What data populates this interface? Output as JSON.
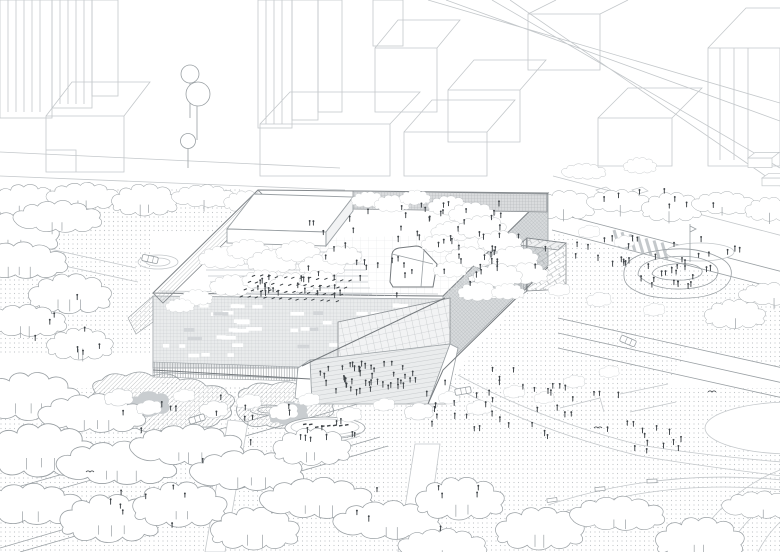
{
  "meta": {
    "title": "Axonometric architectural site drawing",
    "description": "Black-and-white axonometric line drawing of a large rectangular cultural building with a rooftop terrace full of trees and people, surrounded by plazas, parks with cloud-shaped trees, roads with cars, a playground spiral, a stage and crowds of tiny figures"
  },
  "palette": {
    "ink_light": "#c4c8cb",
    "ink_mid": "#9aa0a4",
    "ink_dark": "#757a7e",
    "figure": "#3e4347",
    "dot": "#c2c6c9",
    "facade_sw_fill": "#e9ebec",
    "facade_sw_tex": "#c3c7ca",
    "facade_se_fill": "#d7dadc",
    "facade_se_tex": "#aeb3b6",
    "pergola_fill": "#dadcde",
    "island_fill": "#e0e3e5",
    "island_dark": "#c9cdd0",
    "glass_fill": "#f2f3f4",
    "steps_fill": "#eaeced",
    "window_dark": "#d2d5d8",
    "roof_grid": "#e4e6e8"
  },
  "crowds": [
    {
      "name": "roof-event-audience",
      "cx": 305,
      "cy": 290,
      "rx": 55,
      "ry": 14,
      "n": 22,
      "seed": 11
    },
    {
      "name": "roof-scatter",
      "cx": 400,
      "cy": 250,
      "rx": 120,
      "ry": 48,
      "n": 40,
      "seed": 12
    },
    {
      "name": "roof-back-walk",
      "cx": 450,
      "cy": 212,
      "rx": 88,
      "ry": 10,
      "n": 14,
      "seed": 13
    },
    {
      "name": "roof-right-garden",
      "cx": 495,
      "cy": 255,
      "rx": 55,
      "ry": 40,
      "n": 16,
      "seed": 14
    },
    {
      "name": "entrance-steps-crowd",
      "cx": 368,
      "cy": 380,
      "rx": 50,
      "ry": 18,
      "n": 46,
      "seed": 15
    },
    {
      "name": "main-plaza-crowd",
      "cx": 520,
      "cy": 405,
      "rx": 120,
      "ry": 35,
      "n": 40,
      "seed": 16
    },
    {
      "name": "promenade-walkers",
      "cx": 660,
      "cy": 440,
      "rx": 90,
      "ry": 18,
      "n": 14,
      "seed": 17
    },
    {
      "name": "north-east-plaza",
      "cx": 610,
      "cy": 250,
      "rx": 55,
      "ry": 18,
      "n": 12,
      "seed": 18
    },
    {
      "name": "sidewalk-top",
      "cx": 660,
      "cy": 205,
      "rx": 100,
      "ry": 12,
      "n": 8,
      "seed": 19
    },
    {
      "name": "park-left",
      "cx": 140,
      "cy": 470,
      "rx": 130,
      "ry": 60,
      "n": 12,
      "seed": 20
    },
    {
      "name": "park-bottom",
      "cx": 430,
      "cy": 505,
      "rx": 120,
      "ry": 35,
      "n": 8,
      "seed": 21
    },
    {
      "name": "west-walk",
      "cx": 70,
      "cy": 330,
      "rx": 45,
      "ry": 38,
      "n": 8,
      "seed": 22
    },
    {
      "name": "garden-islands",
      "cx": 230,
      "cy": 408,
      "rx": 70,
      "ry": 14,
      "n": 10,
      "seed": 23
    },
    {
      "name": "stage-crowd",
      "cx": 330,
      "cy": 433,
      "rx": 40,
      "ry": 10,
      "n": 10,
      "seed": 24
    },
    {
      "name": "playground-kids",
      "cx": 678,
      "cy": 277,
      "rx": 40,
      "ry": 16,
      "n": 20,
      "seed": 25
    },
    {
      "name": "street-b-walkers",
      "cx": 640,
      "cy": 252,
      "rx": 110,
      "ry": 14,
      "n": 12,
      "seed": 26
    }
  ],
  "event_rows": {
    "x0": 252,
    "y0": 276,
    "cols": 13,
    "rows": 4,
    "dx": 8,
    "dy": 0.4,
    "row_dx": -4,
    "row_dy": 7,
    "seed": 31
  },
  "windows": {
    "x0": 158,
    "x1": 434,
    "rows": [
      304,
      312,
      320,
      328,
      336,
      344,
      353
    ],
    "per_row": 8,
    "w_min": 6,
    "w_max": 16,
    "h": 3.6,
    "seed": 41,
    "cut_line": {
      "x_from": 302,
      "y_from": 366,
      "x_to": 445,
      "y_to": 298
    }
  },
  "facade_slots": [
    {
      "x": 476,
      "y": 262,
      "w": 24,
      "h": 7,
      "rot": -18
    },
    {
      "x": 468,
      "y": 277,
      "w": 17,
      "h": 6,
      "rot": -18
    },
    {
      "x": 500,
      "y": 250,
      "w": 6,
      "h": 26,
      "rot": 0
    },
    {
      "x": 502,
      "y": 209,
      "w": 16,
      "h": 6,
      "rot": -40
    }
  ],
  "trees": {
    "park": [
      [
        15,
        235,
        0.8,
        1,
        2
      ],
      [
        60,
        218,
        0.7,
        2,
        2
      ],
      [
        20,
        262,
        0.8,
        2,
        3
      ],
      [
        70,
        295,
        0.75,
        1,
        3
      ],
      [
        25,
        322,
        0.7,
        2,
        2
      ],
      [
        80,
        345,
        0.6,
        1,
        2
      ],
      [
        30,
        398,
        0.9,
        1,
        3
      ],
      [
        95,
        415,
        0.85,
        2,
        3
      ],
      [
        40,
        452,
        1.0,
        1,
        3
      ],
      [
        120,
        465,
        0.95,
        2,
        3
      ],
      [
        30,
        506,
        0.9,
        2,
        2
      ],
      [
        110,
        520,
        0.9,
        1,
        3
      ],
      [
        190,
        447,
        0.9,
        2,
        3
      ],
      [
        180,
        506,
        0.85,
        1,
        2
      ],
      [
        250,
        472,
        0.9,
        2,
        3
      ],
      [
        255,
        530,
        0.8,
        1,
        2
      ],
      [
        320,
        500,
        0.9,
        2,
        3
      ],
      [
        312,
        448,
        0.7,
        1,
        2
      ],
      [
        390,
        522,
        0.85,
        2,
        2
      ],
      [
        460,
        500,
        0.8,
        1,
        2
      ],
      [
        445,
        546,
        0.7,
        2,
        1
      ],
      [
        540,
        530,
        0.8,
        1,
        2
      ],
      [
        620,
        515,
        0.75,
        2,
        2
      ],
      [
        700,
        540,
        0.8,
        1,
        2
      ],
      [
        762,
        506,
        0.6,
        2,
        1
      ],
      [
        735,
        315,
        0.55,
        1,
        1
      ],
      [
        772,
        295,
        0.5,
        2,
        1
      ]
    ],
    "hedge_top": [
      [
        25,
        202,
        0.62,
        1,
        2
      ],
      [
        85,
        197,
        0.58,
        2,
        2
      ],
      [
        145,
        201,
        0.6,
        1,
        2
      ],
      [
        205,
        197,
        0.5,
        2,
        1
      ],
      [
        246,
        202,
        0.4,
        1,
        1
      ]
    ],
    "hedge_right": [
      [
        565,
        206,
        0.55,
        1,
        1
      ],
      [
        620,
        202,
        0.5,
        2,
        1
      ],
      [
        672,
        208,
        0.55,
        1,
        1
      ],
      [
        725,
        204,
        0.5,
        2,
        1
      ],
      [
        770,
        210,
        0.45,
        1,
        1
      ],
      [
        585,
        172,
        0.35,
        2,
        0
      ],
      [
        640,
        166,
        0.3,
        1,
        0
      ]
    ],
    "roof": [
      [
        222,
        258,
        0.42
      ],
      [
        248,
        250,
        0.38
      ],
      [
        272,
        262,
        0.45
      ],
      [
        298,
        252,
        0.4
      ],
      [
        322,
        266,
        0.42
      ],
      [
        342,
        256,
        0.36
      ],
      [
        232,
        286,
        0.4
      ],
      [
        262,
        280,
        0.36
      ],
      [
        292,
        284,
        0.4
      ],
      [
        318,
        280,
        0.34
      ],
      [
        448,
        206,
        0.36
      ],
      [
        472,
        214,
        0.42
      ],
      [
        452,
        232,
        0.38
      ],
      [
        482,
        228,
        0.44
      ],
      [
        500,
        242,
        0.4
      ],
      [
        515,
        258,
        0.42
      ],
      [
        526,
        274,
        0.4
      ],
      [
        498,
        276,
        0.44
      ],
      [
        468,
        258,
        0.4
      ],
      [
        440,
        244,
        0.34
      ],
      [
        450,
        270,
        0.3
      ],
      [
        478,
        292,
        0.36
      ],
      [
        508,
        292,
        0.3
      ],
      [
        368,
        200,
        0.3
      ],
      [
        392,
        204,
        0.32
      ],
      [
        415,
        198,
        0.28
      ],
      [
        196,
        298,
        0.3
      ],
      [
        180,
        306,
        0.26
      ]
    ],
    "bushes": [
      [
        120,
        398,
        0.4
      ],
      [
        150,
        408,
        0.35
      ],
      [
        185,
        396,
        0.3
      ],
      [
        215,
        410,
        0.4
      ],
      [
        250,
        402,
        0.35
      ],
      [
        285,
        412,
        0.4
      ],
      [
        310,
        400,
        0.3
      ],
      [
        350,
        415,
        0.35
      ],
      [
        385,
        405,
        0.3
      ],
      [
        420,
        412,
        0.4
      ],
      [
        450,
        398,
        0.3
      ],
      [
        480,
        408,
        0.35
      ],
      [
        515,
        392,
        0.3
      ],
      [
        545,
        398,
        0.28
      ],
      [
        575,
        382,
        0.3
      ],
      [
        610,
        372,
        0.28
      ],
      [
        590,
        232,
        0.3
      ],
      [
        625,
        242,
        0.28
      ],
      [
        560,
        290,
        0.3
      ],
      [
        600,
        300,
        0.34
      ],
      [
        655,
        310,
        0.3
      ]
    ]
  },
  "cars": [
    {
      "x": 197,
      "y": 419,
      "a": -17
    },
    {
      "x": 628,
      "y": 341,
      "a": 23
    },
    {
      "x": 463,
      "y": 391,
      "a": -10
    },
    {
      "x": 150,
      "y": 259,
      "a": 12
    }
  ],
  "birds": [
    [
      598,
      428
    ],
    [
      712,
      392
    ],
    [
      90,
      472
    ]
  ],
  "tile_diamonds": [
    [
      596,
      190
    ],
    [
      614,
      198
    ],
    [
      600,
      206
    ],
    [
      632,
      190
    ]
  ],
  "kiosks": [
    [
      748,
      158,
      24,
      16
    ],
    [
      762,
      178,
      22,
      13
    ]
  ],
  "benches": [
    [
      552,
      500,
      -8
    ],
    [
      600,
      489,
      -6
    ],
    [
      652,
      481,
      -2
    ]
  ],
  "crosswalk": {
    "x0": 614,
    "x1": 662,
    "step": 8
  },
  "features": {
    "pond": {
      "cx": 700,
      "cy": 252,
      "rx": 34,
      "ry": 9
    },
    "big_ellipse": {
      "cx": 793,
      "cy": 428,
      "rx": 88,
      "ry": 26
    },
    "stage": {
      "cx": 325,
      "cy": 428,
      "rx": 40,
      "ry": 11
    },
    "playground": {
      "cx": 678,
      "cy": 277
    },
    "driveway_oval": {
      "cx": 158,
      "cy": 262,
      "rx": 20,
      "ry": 7
    }
  }
}
